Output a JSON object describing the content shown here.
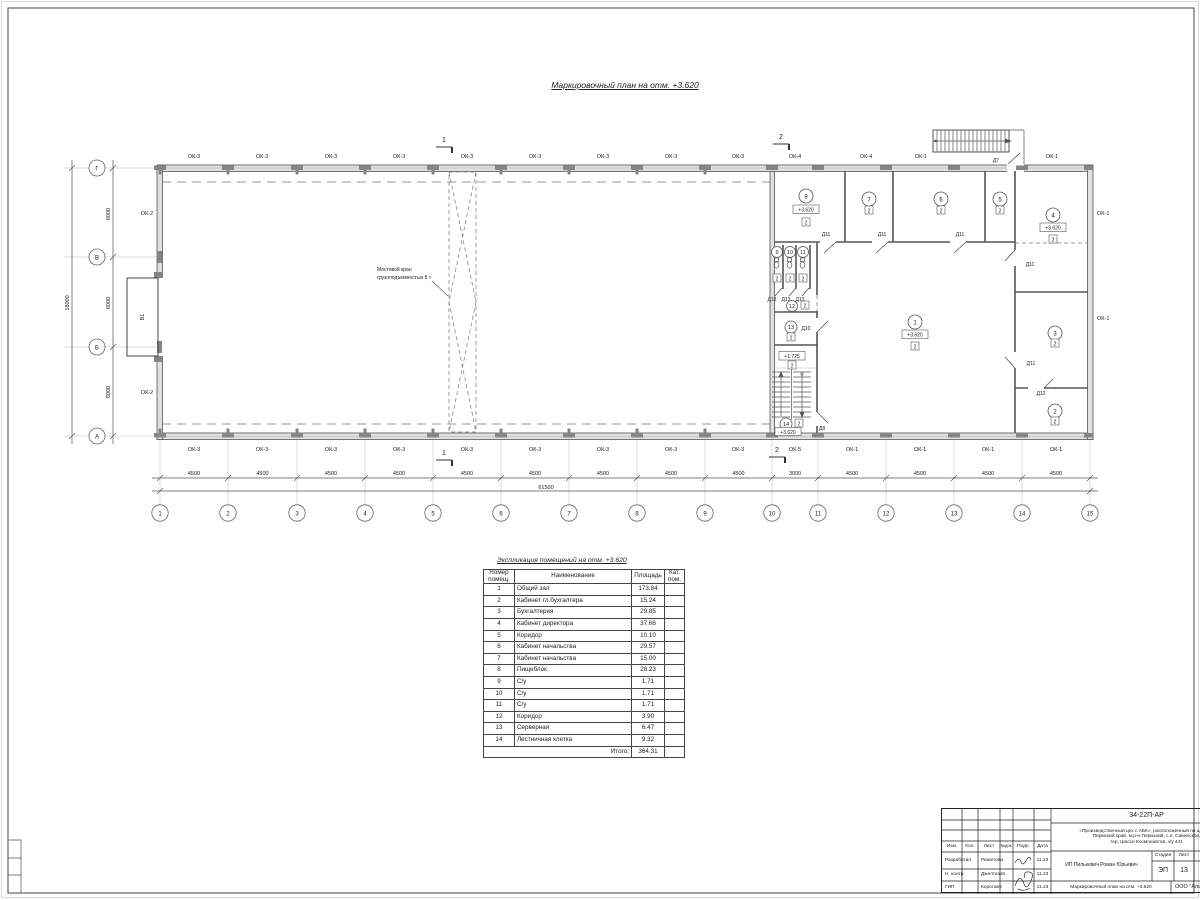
{
  "page": {
    "plan_title": "Маркировочный план  на отм. +3.620"
  },
  "plan": {
    "grid_rows": [
      "Г",
      "В",
      "Б",
      "А"
    ],
    "grid_cols": [
      "1",
      "2",
      "3",
      "4",
      "5",
      "6",
      "7",
      "8",
      "9",
      "10",
      "11",
      "12",
      "13",
      "14",
      "15"
    ],
    "dims_bottom": [
      "4500",
      "4500",
      "4500",
      "4500",
      "4500",
      "4500",
      "4500",
      "4500",
      "4500",
      "3000",
      "4500",
      "4500",
      "4500",
      "4500"
    ],
    "dim_total_bottom": "61500",
    "dims_left": [
      "6000",
      "6000",
      "6000"
    ],
    "dim_total_left": "18000",
    "win_top": [
      "ОК-3",
      "ОК-3",
      "ОК-3",
      "ОК-3",
      "ОК-3",
      "ОК-3",
      "ОК-3",
      "ОК-3",
      "ОК-3",
      "ОК-4",
      "ОК-4",
      "ОК-1",
      "ОК-1"
    ],
    "win_bottom": [
      "ОК-3",
      "ОК-3",
      "ОК-3",
      "ОК-3",
      "ОК-3",
      "ОК-3",
      "ОК-3",
      "ОК-3",
      "ОК-3",
      "ОК-5",
      "ОК-1",
      "ОК-1",
      "ОК-1",
      "ОК-1"
    ],
    "win_left": [
      "ОК-2",
      "ОК-2"
    ],
    "win_right": [
      "ОК-1",
      "ОК-1"
    ],
    "rooms": [
      "1",
      "2",
      "3",
      "4",
      "5",
      "6",
      "7",
      "8",
      "9",
      "10",
      "11",
      "12",
      "13",
      "14"
    ],
    "level_main": "+3.620",
    "level_landing": "+1.725",
    "cat": "2",
    "door_d7": "Д7",
    "door_d8": "Д8",
    "door_d10": "Д10",
    "door_d11": "Д11",
    "door_d12": "Д12",
    "door_d13": "Д13",
    "gate": "В1",
    "section_1": "1",
    "section_2": "2",
    "crane_note_line1": "Мостовой кран",
    "crane_note_line2": "грузоподъемностью 5 т"
  },
  "table": {
    "title": "Экспликация помещений на отм. +3.620",
    "col_num": "Номер помещ.",
    "col_name": "Наименование",
    "col_area": "Площадь",
    "col_cat": "Кат. пом.",
    "rows": [
      {
        "num": "1",
        "name": "Общий зал",
        "area": "173.84",
        "cat": ""
      },
      {
        "num": "2",
        "name": "Кабинет гл.бухгалтера",
        "area": "15.24",
        "cat": ""
      },
      {
        "num": "3",
        "name": "Бухгалтерия",
        "area": "29.85",
        "cat": ""
      },
      {
        "num": "4",
        "name": "Кабинет директора",
        "area": "37.66",
        "cat": ""
      },
      {
        "num": "5",
        "name": "Коридор",
        "area": "10.10",
        "cat": ""
      },
      {
        "num": "6",
        "name": "Кабинет начальства",
        "area": "29.57",
        "cat": ""
      },
      {
        "num": "7",
        "name": "Кабинет начальства",
        "area": "15.00",
        "cat": ""
      },
      {
        "num": "8",
        "name": "Пищеблок",
        "area": "28.23",
        "cat": ""
      },
      {
        "num": "9",
        "name": "С/у",
        "area": "1.71",
        "cat": ""
      },
      {
        "num": "10",
        "name": "С/у",
        "area": "1.71",
        "cat": ""
      },
      {
        "num": "11",
        "name": "С/у",
        "area": "1.71",
        "cat": ""
      },
      {
        "num": "12",
        "name": "Коридор",
        "area": "3.90",
        "cat": ""
      },
      {
        "num": "13",
        "name": "Серверная",
        "area": "6.47",
        "cat": ""
      },
      {
        "num": "14",
        "name": "Лестничная клетка",
        "area": "9.32",
        "cat": ""
      }
    ],
    "total_label": "Итого:",
    "total_value": "364.31"
  },
  "notes": {
    "items": [
      "1. Разрез 1-1 выполнен см. л. АР-16.",
      "2. Разрез 2-2 выполнен см. л. АР-17.",
      "3. Спецификация заполнения оконных и дверных проемов выполнена см. л. АР-18.",
      "4. Экспликация полов выполнена см. л. АР-18."
    ]
  },
  "titleblock": {
    "doc_number": "34-22П-АР",
    "project_line1": "«Производственный цех с АБК», расположенный по адресу:",
    "project_line2": "Пермский край, м.р-н Пермский, с.п. Савинское,",
    "project_line3": "тер. Шоссе Космонавтов, з/у 441",
    "col_izm": "Изм.",
    "col_kol": "Кол.",
    "col_list": "Лист",
    "col_ndok": "№док.",
    "col_podp": "Подп.",
    "col_data": "Дата",
    "row1_role": "Разработал",
    "row1_name": "Решетова",
    "row1_date": "11.23",
    "row2_role": "Н. контр.",
    "row2_name": "Джелтазов",
    "row2_date": "11.23",
    "row3_role": "ГИП",
    "row3_name": "Коротаев",
    "row3_date": "11.23",
    "client": "ИП Пилькевич Роман Юрьевич",
    "stage_label": "Стадия",
    "sheet_label": "Лист",
    "stage_value": "ЭП",
    "sheet_value": "13",
    "sheet_title": "Маркировочный план на отм. +3.620",
    "org": "ООО \"Аль"
  }
}
